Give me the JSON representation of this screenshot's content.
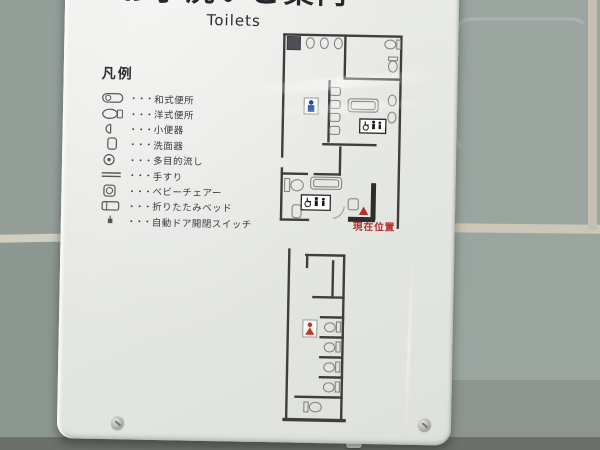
{
  "sign": {
    "title_jp": "お手洗いご案内",
    "title_en": "Toilets",
    "legend": {
      "heading": "凡例",
      "dots": "・・・",
      "items": [
        {
          "icon": "squat-toilet-icon",
          "label": "和式便所"
        },
        {
          "icon": "western-toilet-icon",
          "label": "洋式便所"
        },
        {
          "icon": "urinal-icon",
          "label": "小便器"
        },
        {
          "icon": "washbasin-icon",
          "label": "洗面器"
        },
        {
          "icon": "multipurpose-sink-icon",
          "label": "多目的流し"
        },
        {
          "icon": "handrail-icon",
          "label": "手すり"
        },
        {
          "icon": "baby-chair-icon",
          "label": "ベビーチェアー"
        },
        {
          "icon": "folding-bed-icon",
          "label": "折りたたみベッド"
        },
        {
          "icon": "auto-door-switch-icon",
          "label": "自動ドア開閉スイッチ"
        }
      ]
    },
    "map": {
      "current_location": "現在位置"
    }
  },
  "colors": {
    "wall_tile_left": "#949f9a",
    "wall_tile_right": "#9ba5a0",
    "grout": "#ccc7b7",
    "panel": "#e6e8e4",
    "map_wall": "#3e3e3e",
    "accent_red": "#b2312b",
    "accent_blue": "#1e4f9c"
  }
}
